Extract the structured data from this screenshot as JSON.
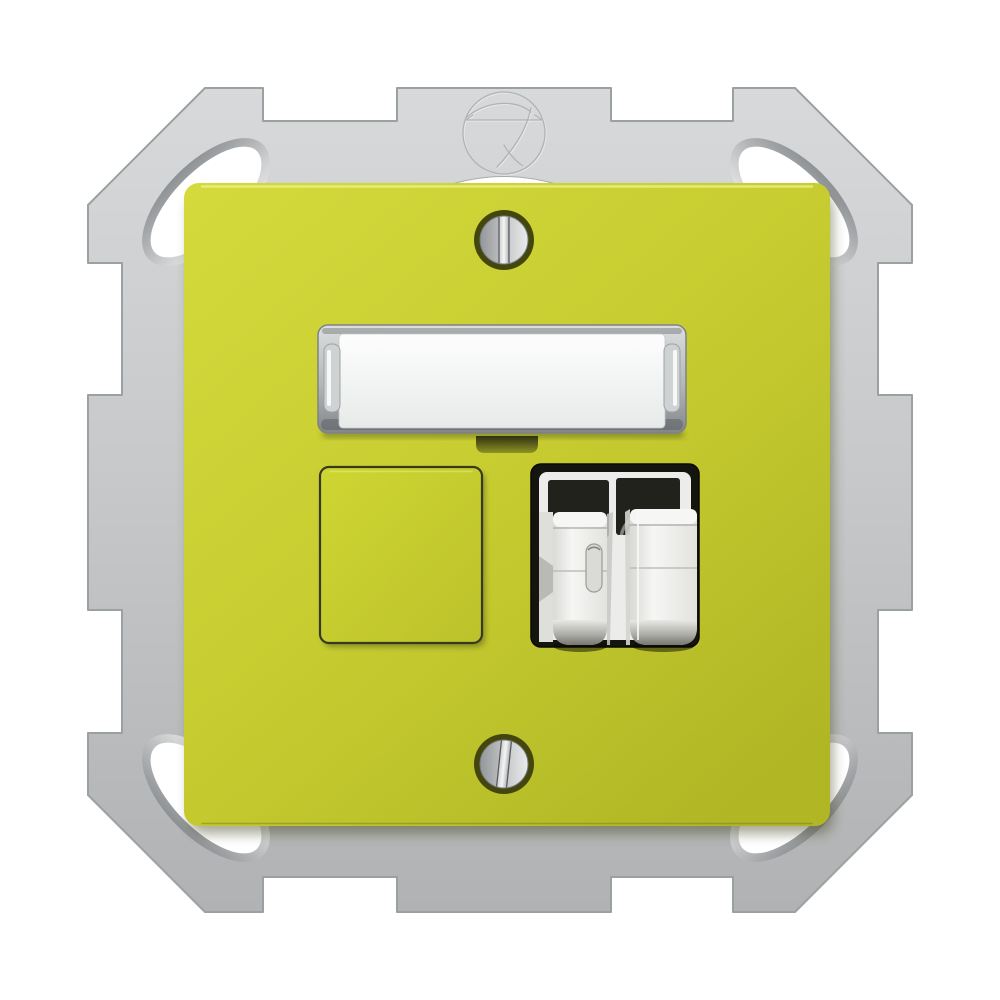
{
  "image": {
    "kind": "product-photo",
    "subject": "flush-mount network outlet with lime-yellow cover plate on silver metal support frame",
    "background": "#ffffff"
  },
  "colors": {
    "metal_light": "#d8d9da",
    "metal_mid": "#c7c9ca",
    "metal_dark": "#b0b2b3",
    "metal_edge": "#9ba0a2",
    "bevel_dark": "#8e9194",
    "bevel_light": "#eceded",
    "hole_white": "#ffffff",
    "plate_light": "#d4da3c",
    "plate_mid": "#c7cd30",
    "plate_dark": "#b0b624",
    "plate_outline": "#383a20",
    "plate_top_highlight": "#eef38a",
    "shadow_olive": "#3f421c",
    "label_frame_light": "#dcdedf",
    "label_frame_mid": "#b4b7b9",
    "label_frame_dark": "#83878a",
    "paper_white": "#fdfdfd",
    "paper_shade": "#e8eaea",
    "tab_dark": "#2e3110",
    "tab_light": "#8e9323",
    "recess_black": "#14150e",
    "window_black": "#21221b",
    "module_white": "#ececea",
    "flap_light": "#f6f6f4",
    "flap_mid": "#d9d9d6",
    "flap_curl_dark": "#77786f",
    "spring_gray": "#83837d",
    "screw_ring": "#43470e",
    "screw_dark": "#94979a",
    "screw_mid": "#c6c8ca",
    "screw_light": "#e9eaeb",
    "slot_light": "#f4f5f4",
    "slot_edge": "#595c5e",
    "emboss_dark": "#b0b3b5",
    "emboss_light": "#e6e7e8"
  },
  "components": {
    "support_frame": "metal support frame with chamfered corners, edge notches and oval claw holes",
    "emblem": "embossed round manufacturer emblem",
    "central_opening": "round frame opening peeking above cover plate",
    "cover_plate": "lime-yellow square cover plate",
    "top_screw": "slotted fixing screw (top)",
    "bottom_screw": "slotted fixing screw (bottom)",
    "label_window": "clear labeling window",
    "label_text": "",
    "blank_module": "blank yellow port cover",
    "connector_module": "white dual-port connector with dust flaps",
    "port_count": "2"
  }
}
